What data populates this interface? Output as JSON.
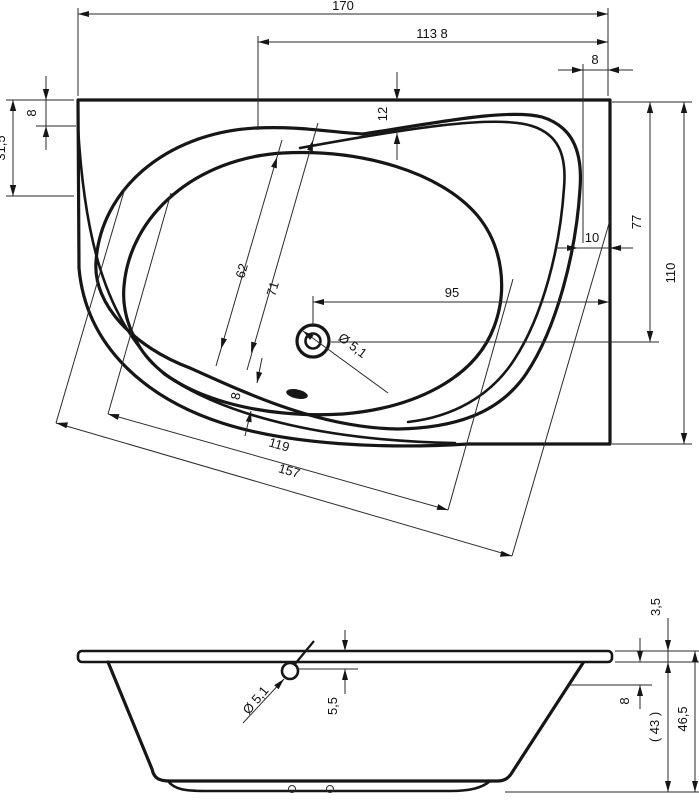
{
  "drawing": {
    "type": "bathtub-technical-drawing",
    "line_color": "#161616",
    "background": "#ffffff"
  },
  "top_view": {
    "dim_overall_length": "170",
    "dim_inner_length": "113 8",
    "dim_rim_right_width": "8",
    "dim_rim_left_top": "8",
    "dim_left_edge": "31,5",
    "dim_rim_top_width": "12",
    "dim_top_to_drain": "77",
    "dim_right_gap": "10",
    "dim_overall_width": "110",
    "dim_drain_to_edge": "95",
    "dim_well_width_inner": "62",
    "dim_well_width_outer": "71",
    "dim_drain_diameter": "Ø 5,1",
    "dim_rim_bottom_width": "8",
    "dim_well_length": "119",
    "dim_outer_length_diag": "157"
  },
  "side_view": {
    "dim_drain_diameter": "Ø 5,1",
    "dim_drain_below_rim": "5,5",
    "dim_rim_thickness": "3,5",
    "dim_rim_to_overflow": "8",
    "dim_body_height": "( 43 )",
    "dim_total_height": "46,5"
  }
}
